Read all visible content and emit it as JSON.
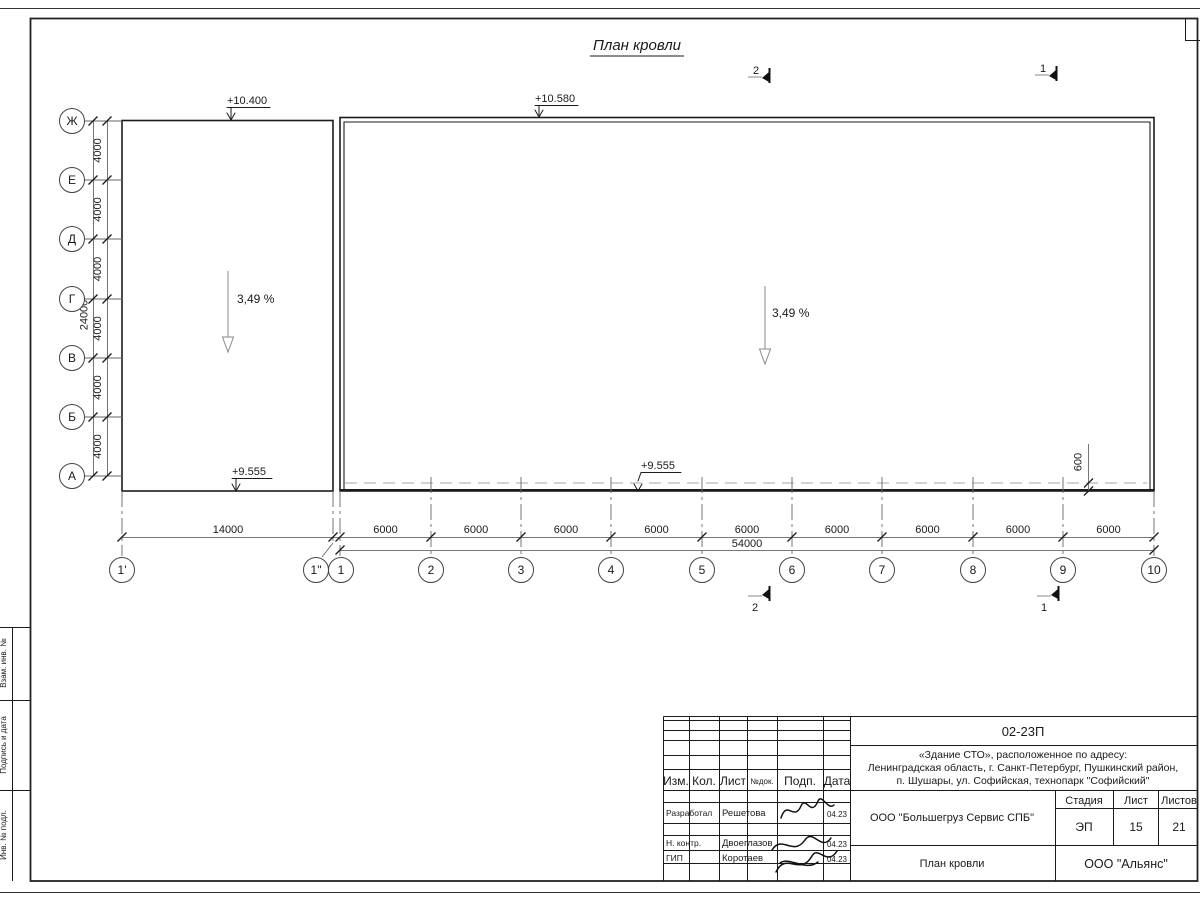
{
  "sheet": {
    "title": "План кровли",
    "sidebar_labels": [
      "Взам. инв. №",
      "Подпись и дата",
      "Инв. № подл."
    ]
  },
  "plan": {
    "elevations": {
      "left_top": "+10.400",
      "right_top": "+10.580",
      "left_bottom": "+9.555",
      "mid_bottom": "+9.555"
    },
    "slopes": {
      "left": "3,49 %",
      "right": "3,49 %"
    },
    "overhang_dim": "600",
    "sections": {
      "one": "1",
      "two": "2"
    }
  },
  "row_axes": {
    "labels": [
      "Ж",
      "Е",
      "Д",
      "Г",
      "В",
      "Б",
      "А"
    ],
    "segment_dim": "4000",
    "total_dim": "24000"
  },
  "col_axes": {
    "labels": [
      "1'",
      "1\"",
      "1",
      "2",
      "3",
      "4",
      "5",
      "6",
      "7",
      "8",
      "9",
      "10"
    ],
    "first_dim": "14000",
    "segment_dim": "6000",
    "total_dim": "54000"
  },
  "titleblock": {
    "doc_number": "02-23П",
    "object_lines": [
      "«Здание СТО», расположенное по адресу:",
      "Ленинградская область, г. Санкт-Петербург, Пушкинский район,",
      "п. Шушары, ул. Софийская, технопарк \"Софийский\""
    ],
    "columns": {
      "izm": "Изм.",
      "kol": "Кол.",
      "list": "Лист",
      "ndok": "№док.",
      "podp": "Подп.",
      "data": "Дата"
    },
    "rows": [
      {
        "role": "Разработал",
        "name": "Решетова",
        "date": "04.23"
      },
      {
        "role": "Н. контр.",
        "name": "Двоеглазов",
        "date": "04.23"
      },
      {
        "role": "ГИП",
        "name": "Коротаев",
        "date": "04.23"
      }
    ],
    "company": "ООО \"Большегруз Сервис СПБ\"",
    "stage": {
      "label": "Стадия",
      "value": "ЭП"
    },
    "sheet": {
      "label": "Лист",
      "value": "15"
    },
    "sheets": {
      "label": "Листов",
      "value": "21"
    },
    "drawing_name": "План кровли",
    "org": "ООО \"Альянс\""
  }
}
